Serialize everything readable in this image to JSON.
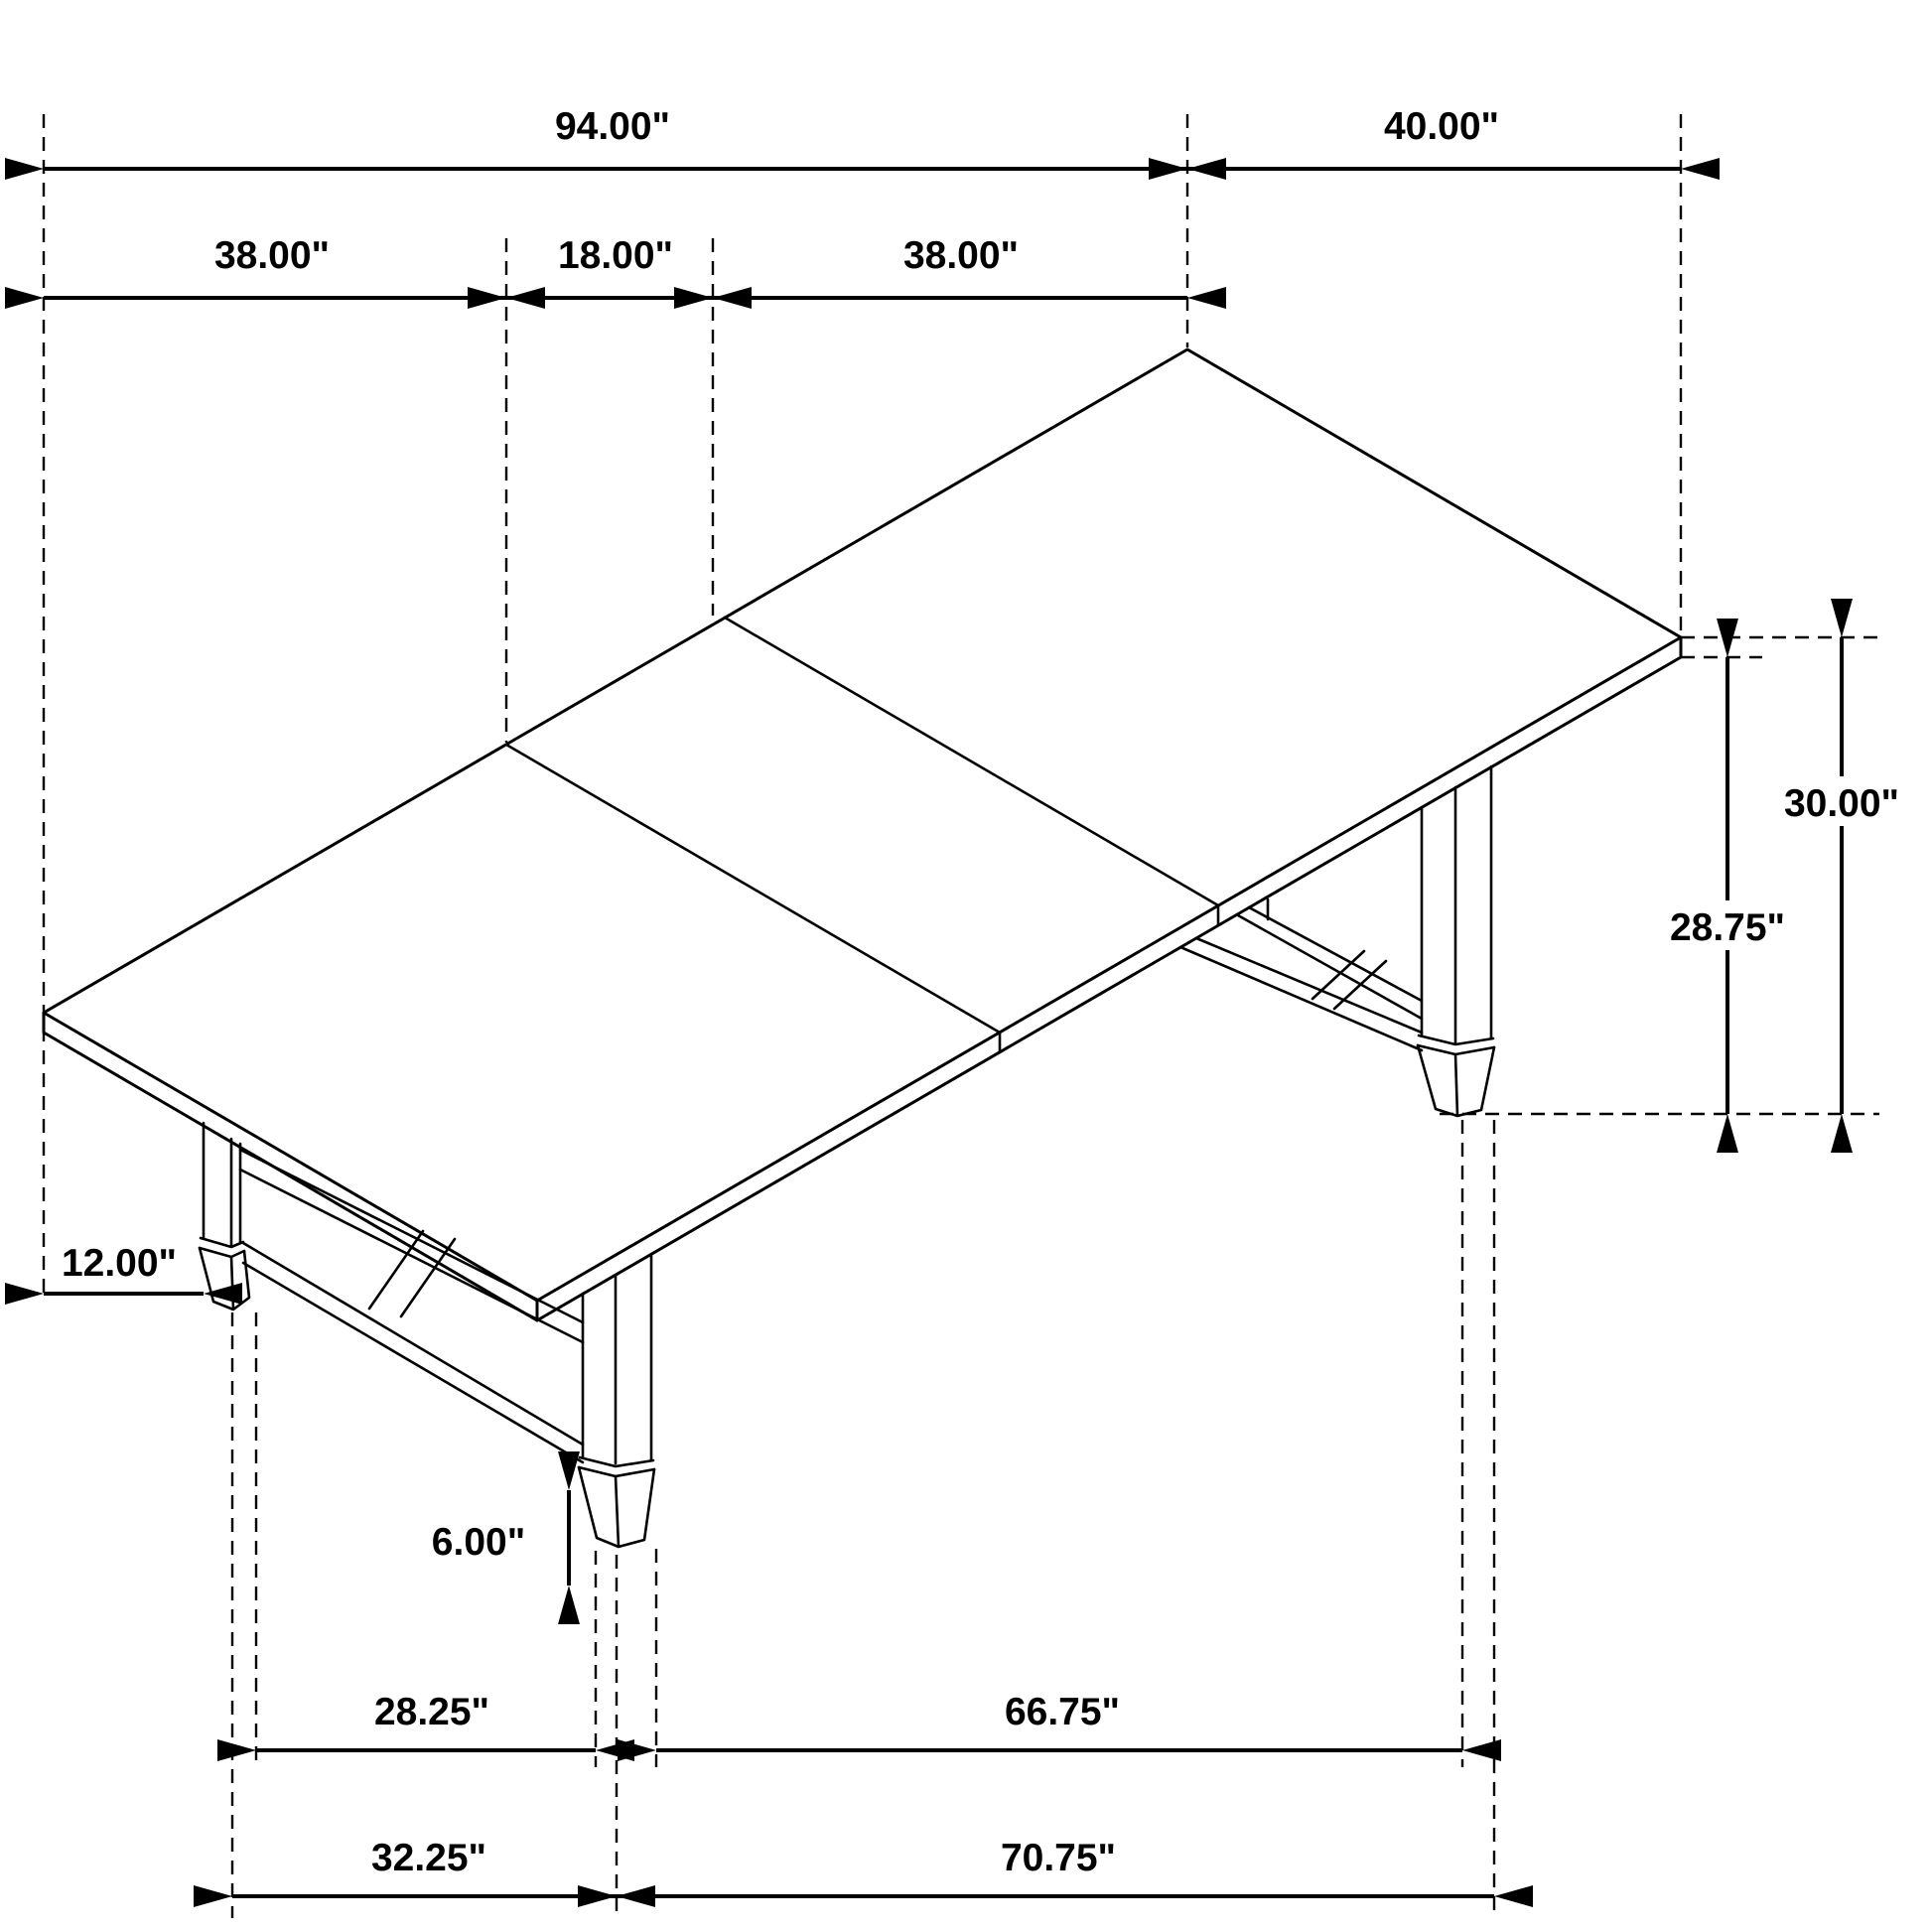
{
  "figure": {
    "type": "isometric-dimension-drawing",
    "subject": "three-panel extendable trestle dining table with tapered feet",
    "line_color": "#000000",
    "background_color": "#ffffff"
  },
  "dims": {
    "overall_length": "94.00\"",
    "width": "40.00\"",
    "panel_a": "38.00\"",
    "leaf": "18.00\"",
    "panel_b": "38.00\"",
    "height": "30.00\"",
    "apron_height": "28.75\"",
    "overhang": "12.00\"",
    "foot": "6.00\"",
    "span_inner_left": "28.25\"",
    "span_inner_right": "66.75\"",
    "span_outer_left": "32.25\"",
    "span_outer_right": "70.75\""
  }
}
